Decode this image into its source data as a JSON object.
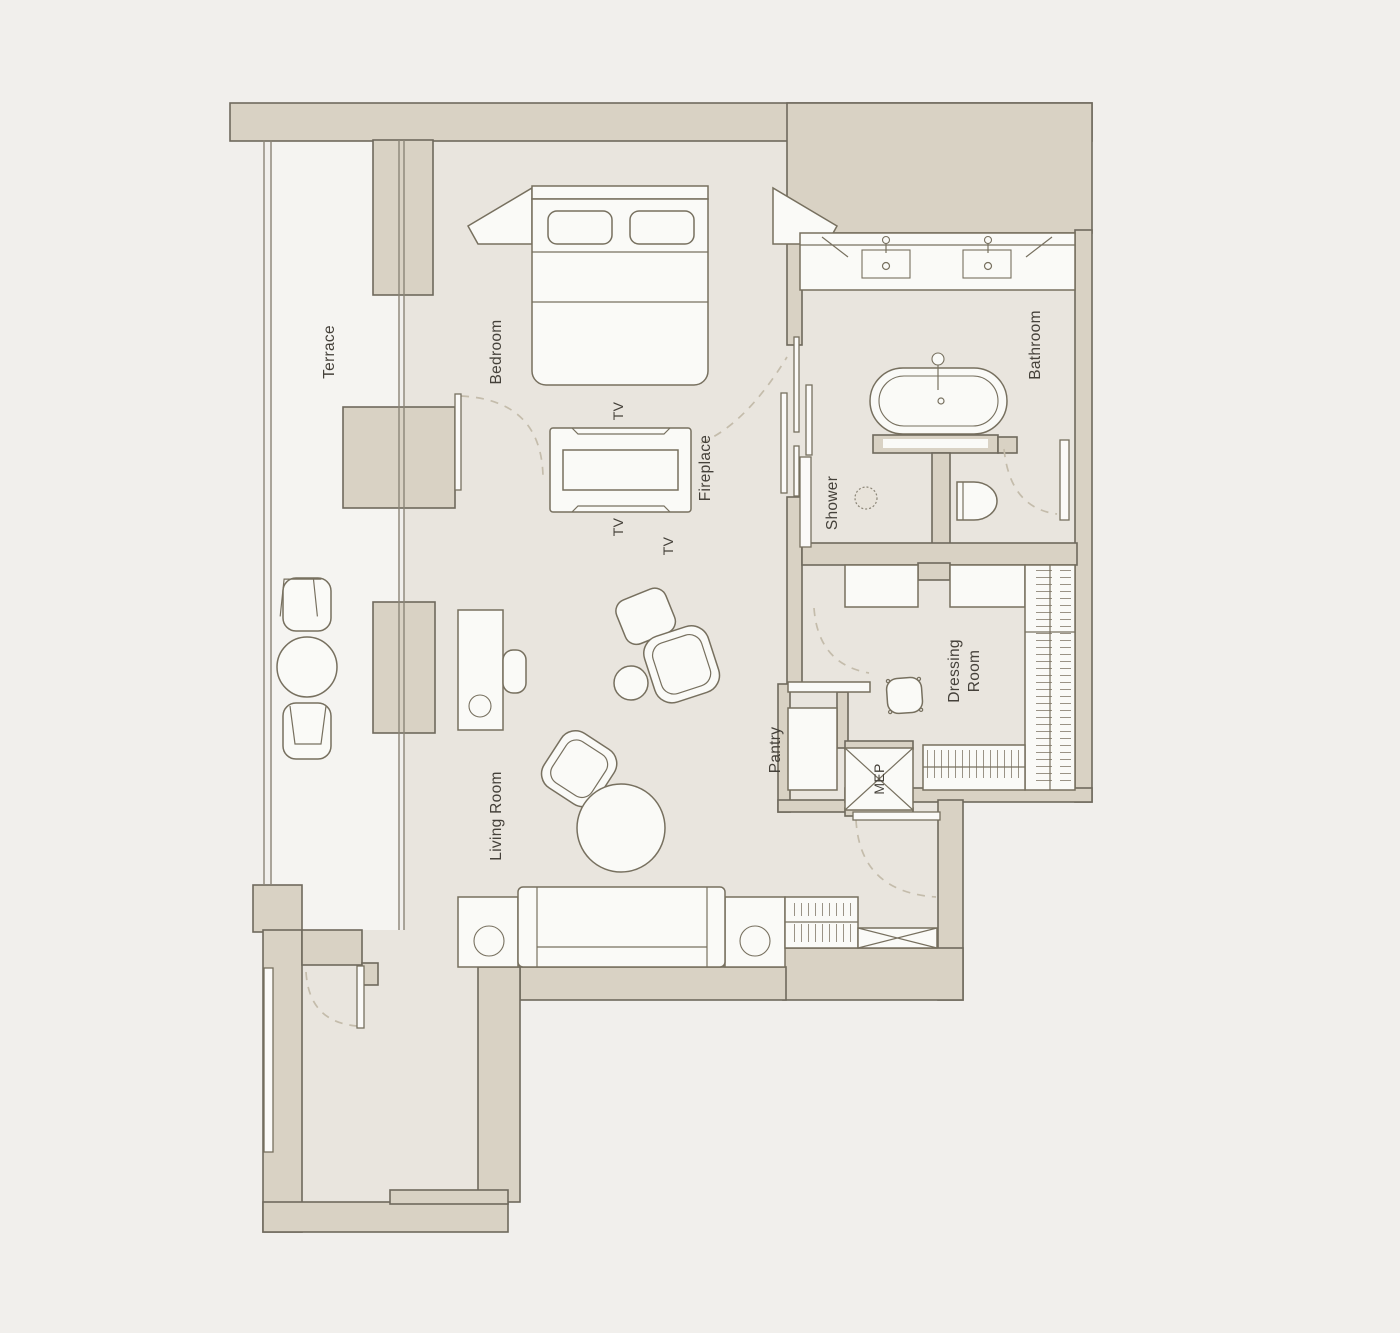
{
  "plan": {
    "kind": "residential-suite-floor-plan",
    "labels": {
      "terrace": "Terrace",
      "bedroom": "Bedroom",
      "tv_1": "TV",
      "tv_2": "TV",
      "tv_3": "TV",
      "fireplace": "Fireplace",
      "bathroom": "Bathroom",
      "shower": "Shower",
      "living_room": "Living Room",
      "pantry": "Pantry",
      "mep": "MEP",
      "dressing_room": "Dressing Room"
    }
  },
  "colors": {
    "background": "#f1efec",
    "wall_fill": "#d9d2c4",
    "wall_stroke": "#6f695d",
    "floor": "#e9e5de",
    "terrace_floor": "#f5f4f1",
    "furniture_fill": "#fafaf7",
    "furniture_stroke": "#77705f",
    "door_swing_dash": "#c4bcab",
    "hatch": "#9a9386",
    "label_text": "#45413a"
  }
}
